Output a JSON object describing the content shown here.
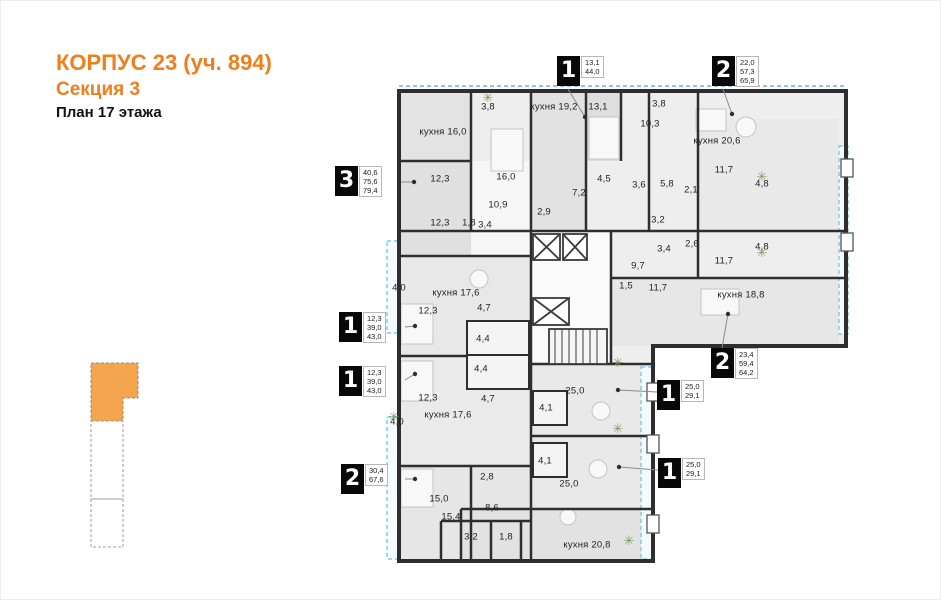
{
  "title": {
    "line1": "КОРПУС 23 (уч. 894)",
    "line2": "Секция 3",
    "line3": "План 17 этажа"
  },
  "colors": {
    "accent_orange": "#ef7e1b",
    "section_highlight": "#f6a54f",
    "balcony_blue": "#86c9e8",
    "wall_dark": "#2e2e2e"
  },
  "plan": {
    "rooms": [
      {
        "label": "кухня 16,0",
        "x": 442,
        "y": 131
      },
      {
        "label": "3,8",
        "x": 487,
        "y": 106
      },
      {
        "label": "16,0",
        "x": 505,
        "y": 176
      },
      {
        "label": "кухня 19,2",
        "x": 553,
        "y": 106
      },
      {
        "label": "13,1",
        "x": 597,
        "y": 106
      },
      {
        "label": "3,8",
        "x": 658,
        "y": 103
      },
      {
        "label": "10,3",
        "x": 649,
        "y": 123
      },
      {
        "label": "кухня 20,6",
        "x": 716,
        "y": 140
      },
      {
        "label": "11,7",
        "x": 723,
        "y": 169
      },
      {
        "label": "4,8",
        "x": 761,
        "y": 183
      },
      {
        "label": "4,5",
        "x": 603,
        "y": 178
      },
      {
        "label": "7,2",
        "x": 578,
        "y": 192
      },
      {
        "label": "3,6",
        "x": 638,
        "y": 184
      },
      {
        "label": "5,8",
        "x": 666,
        "y": 183
      },
      {
        "label": "2,1",
        "x": 690,
        "y": 189
      },
      {
        "label": "3,2",
        "x": 657,
        "y": 219
      },
      {
        "label": "2,9",
        "x": 543,
        "y": 211
      },
      {
        "label": "10,9",
        "x": 497,
        "y": 204
      },
      {
        "label": "1,8",
        "x": 468,
        "y": 222
      },
      {
        "label": "3,4",
        "x": 484,
        "y": 224
      },
      {
        "label": "12,3",
        "x": 439,
        "y": 178
      },
      {
        "label": "12,3",
        "x": 439,
        "y": 222
      },
      {
        "label": "3,4",
        "x": 663,
        "y": 248
      },
      {
        "label": "2,6",
        "x": 691,
        "y": 243
      },
      {
        "label": "9,7",
        "x": 637,
        "y": 265
      },
      {
        "label": "11,7",
        "x": 723,
        "y": 260
      },
      {
        "label": "4,8",
        "x": 761,
        "y": 246
      },
      {
        "label": "1,5",
        "x": 625,
        "y": 285
      },
      {
        "label": "11,7",
        "x": 657,
        "y": 287
      },
      {
        "label": "кухня 18,8",
        "x": 740,
        "y": 294
      },
      {
        "label": "4,0",
        "x": 398,
        "y": 287
      },
      {
        "label": "кухня 17,6",
        "x": 455,
        "y": 292
      },
      {
        "label": "4,7",
        "x": 483,
        "y": 307
      },
      {
        "label": "12,3",
        "x": 427,
        "y": 310
      },
      {
        "label": "4,4",
        "x": 482,
        "y": 338
      },
      {
        "label": "4,4",
        "x": 480,
        "y": 368
      },
      {
        "label": "12,3",
        "x": 427,
        "y": 397
      },
      {
        "label": "4,7",
        "x": 487,
        "y": 398
      },
      {
        "label": "кухня 17,6",
        "x": 447,
        "y": 414
      },
      {
        "label": "4,0",
        "x": 396,
        "y": 421
      },
      {
        "label": "2,8",
        "x": 486,
        "y": 476
      },
      {
        "label": "15,0",
        "x": 438,
        "y": 498
      },
      {
        "label": "15,4",
        "x": 450,
        "y": 516
      },
      {
        "label": "8,6",
        "x": 491,
        "y": 507
      },
      {
        "label": "3,2",
        "x": 470,
        "y": 536
      },
      {
        "label": "1,8",
        "x": 505,
        "y": 536
      },
      {
        "label": "25,0",
        "x": 574,
        "y": 390
      },
      {
        "label": "4,1",
        "x": 545,
        "y": 407
      },
      {
        "label": "4,1",
        "x": 544,
        "y": 460
      },
      {
        "label": "25,0",
        "x": 568,
        "y": 483
      },
      {
        "label": "кухня 20,8",
        "x": 586,
        "y": 544
      }
    ],
    "badges": [
      {
        "digit": "1",
        "values": [
          "13,1",
          "44,0"
        ],
        "x": 556,
        "y": 55,
        "leader": {
          "x1": 567,
          "y1": 88,
          "x2": 584,
          "y2": 116
        }
      },
      {
        "digit": "2",
        "values": [
          "22,0",
          "57,3",
          "65,9"
        ],
        "x": 711,
        "y": 55,
        "leader": {
          "x1": 722,
          "y1": 88,
          "x2": 731,
          "y2": 113
        }
      },
      {
        "digit": "3",
        "values": [
          "40,6",
          "75,6",
          "79,4"
        ],
        "x": 334,
        "y": 165,
        "leader": {
          "x1": 400,
          "y1": 181,
          "x2": 413,
          "y2": 181
        }
      },
      {
        "digit": "1",
        "values": [
          "12,3",
          "39,0",
          "43,0"
        ],
        "x": 338,
        "y": 311,
        "leader": {
          "x1": 404,
          "y1": 326,
          "x2": 414,
          "y2": 325
        }
      },
      {
        "digit": "1",
        "values": [
          "12,3",
          "39,0",
          "43,0"
        ],
        "x": 338,
        "y": 365,
        "leader": {
          "x1": 404,
          "y1": 379,
          "x2": 414,
          "y2": 373
        }
      },
      {
        "digit": "2",
        "values": [
          "30,4",
          "67,6"
        ],
        "x": 340,
        "y": 463,
        "leader": {
          "x1": 404,
          "y1": 478,
          "x2": 414,
          "y2": 478
        }
      },
      {
        "digit": "2",
        "values": [
          "23,4",
          "59,4",
          "64,2"
        ],
        "x": 710,
        "y": 347,
        "leader": {
          "x1": 721,
          "y1": 347,
          "x2": 727,
          "y2": 313
        }
      },
      {
        "digit": "1",
        "values": [
          "25,0",
          "29,1"
        ],
        "x": 656,
        "y": 379,
        "leader": {
          "x1": 656,
          "y1": 391,
          "x2": 617,
          "y2": 389
        }
      },
      {
        "digit": "1",
        "values": [
          "25,0",
          "29,1"
        ],
        "x": 657,
        "y": 457,
        "leader": {
          "x1": 657,
          "y1": 469,
          "x2": 618,
          "y2": 466
        }
      }
    ]
  }
}
